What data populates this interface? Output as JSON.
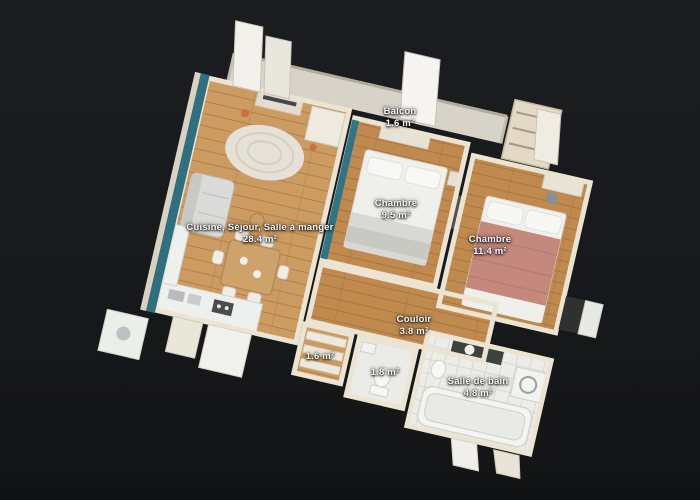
{
  "scene": {
    "description": "3D dollhouse floor plan of an apartment on dark background",
    "background_color": "#17181b",
    "colors": {
      "wood_floor": "#c59258",
      "teal_wall": "#2e6f80",
      "cut_wall": "#ece4d3",
      "tile_floor": "#ecece9",
      "accent_bed_blanket": "#c5887c",
      "label_text": "#ffffff"
    },
    "rooms": [
      {
        "name": "Balcon",
        "area": "1.6 m²",
        "x": 400,
        "y": 118
      },
      {
        "name": "Chambre",
        "area": "9.5 m²",
        "x": 396,
        "y": 210
      },
      {
        "name": "Chambre",
        "area": "11.4 m²",
        "x": 490,
        "y": 246
      },
      {
        "name": "Cuisine, Séjour, Salle à manger",
        "area": "28.4 m²",
        "x": 260,
        "y": 234
      },
      {
        "name": "Couloir",
        "area": "3.8 m²",
        "x": 414,
        "y": 326
      },
      {
        "name": "",
        "area": "1.6 m²",
        "x": 320,
        "y": 357
      },
      {
        "name": "",
        "area": "1.8 m²",
        "x": 385,
        "y": 373
      },
      {
        "name": "Salle de bain",
        "area": "4.8 m²",
        "x": 478,
        "y": 388
      }
    ]
  }
}
